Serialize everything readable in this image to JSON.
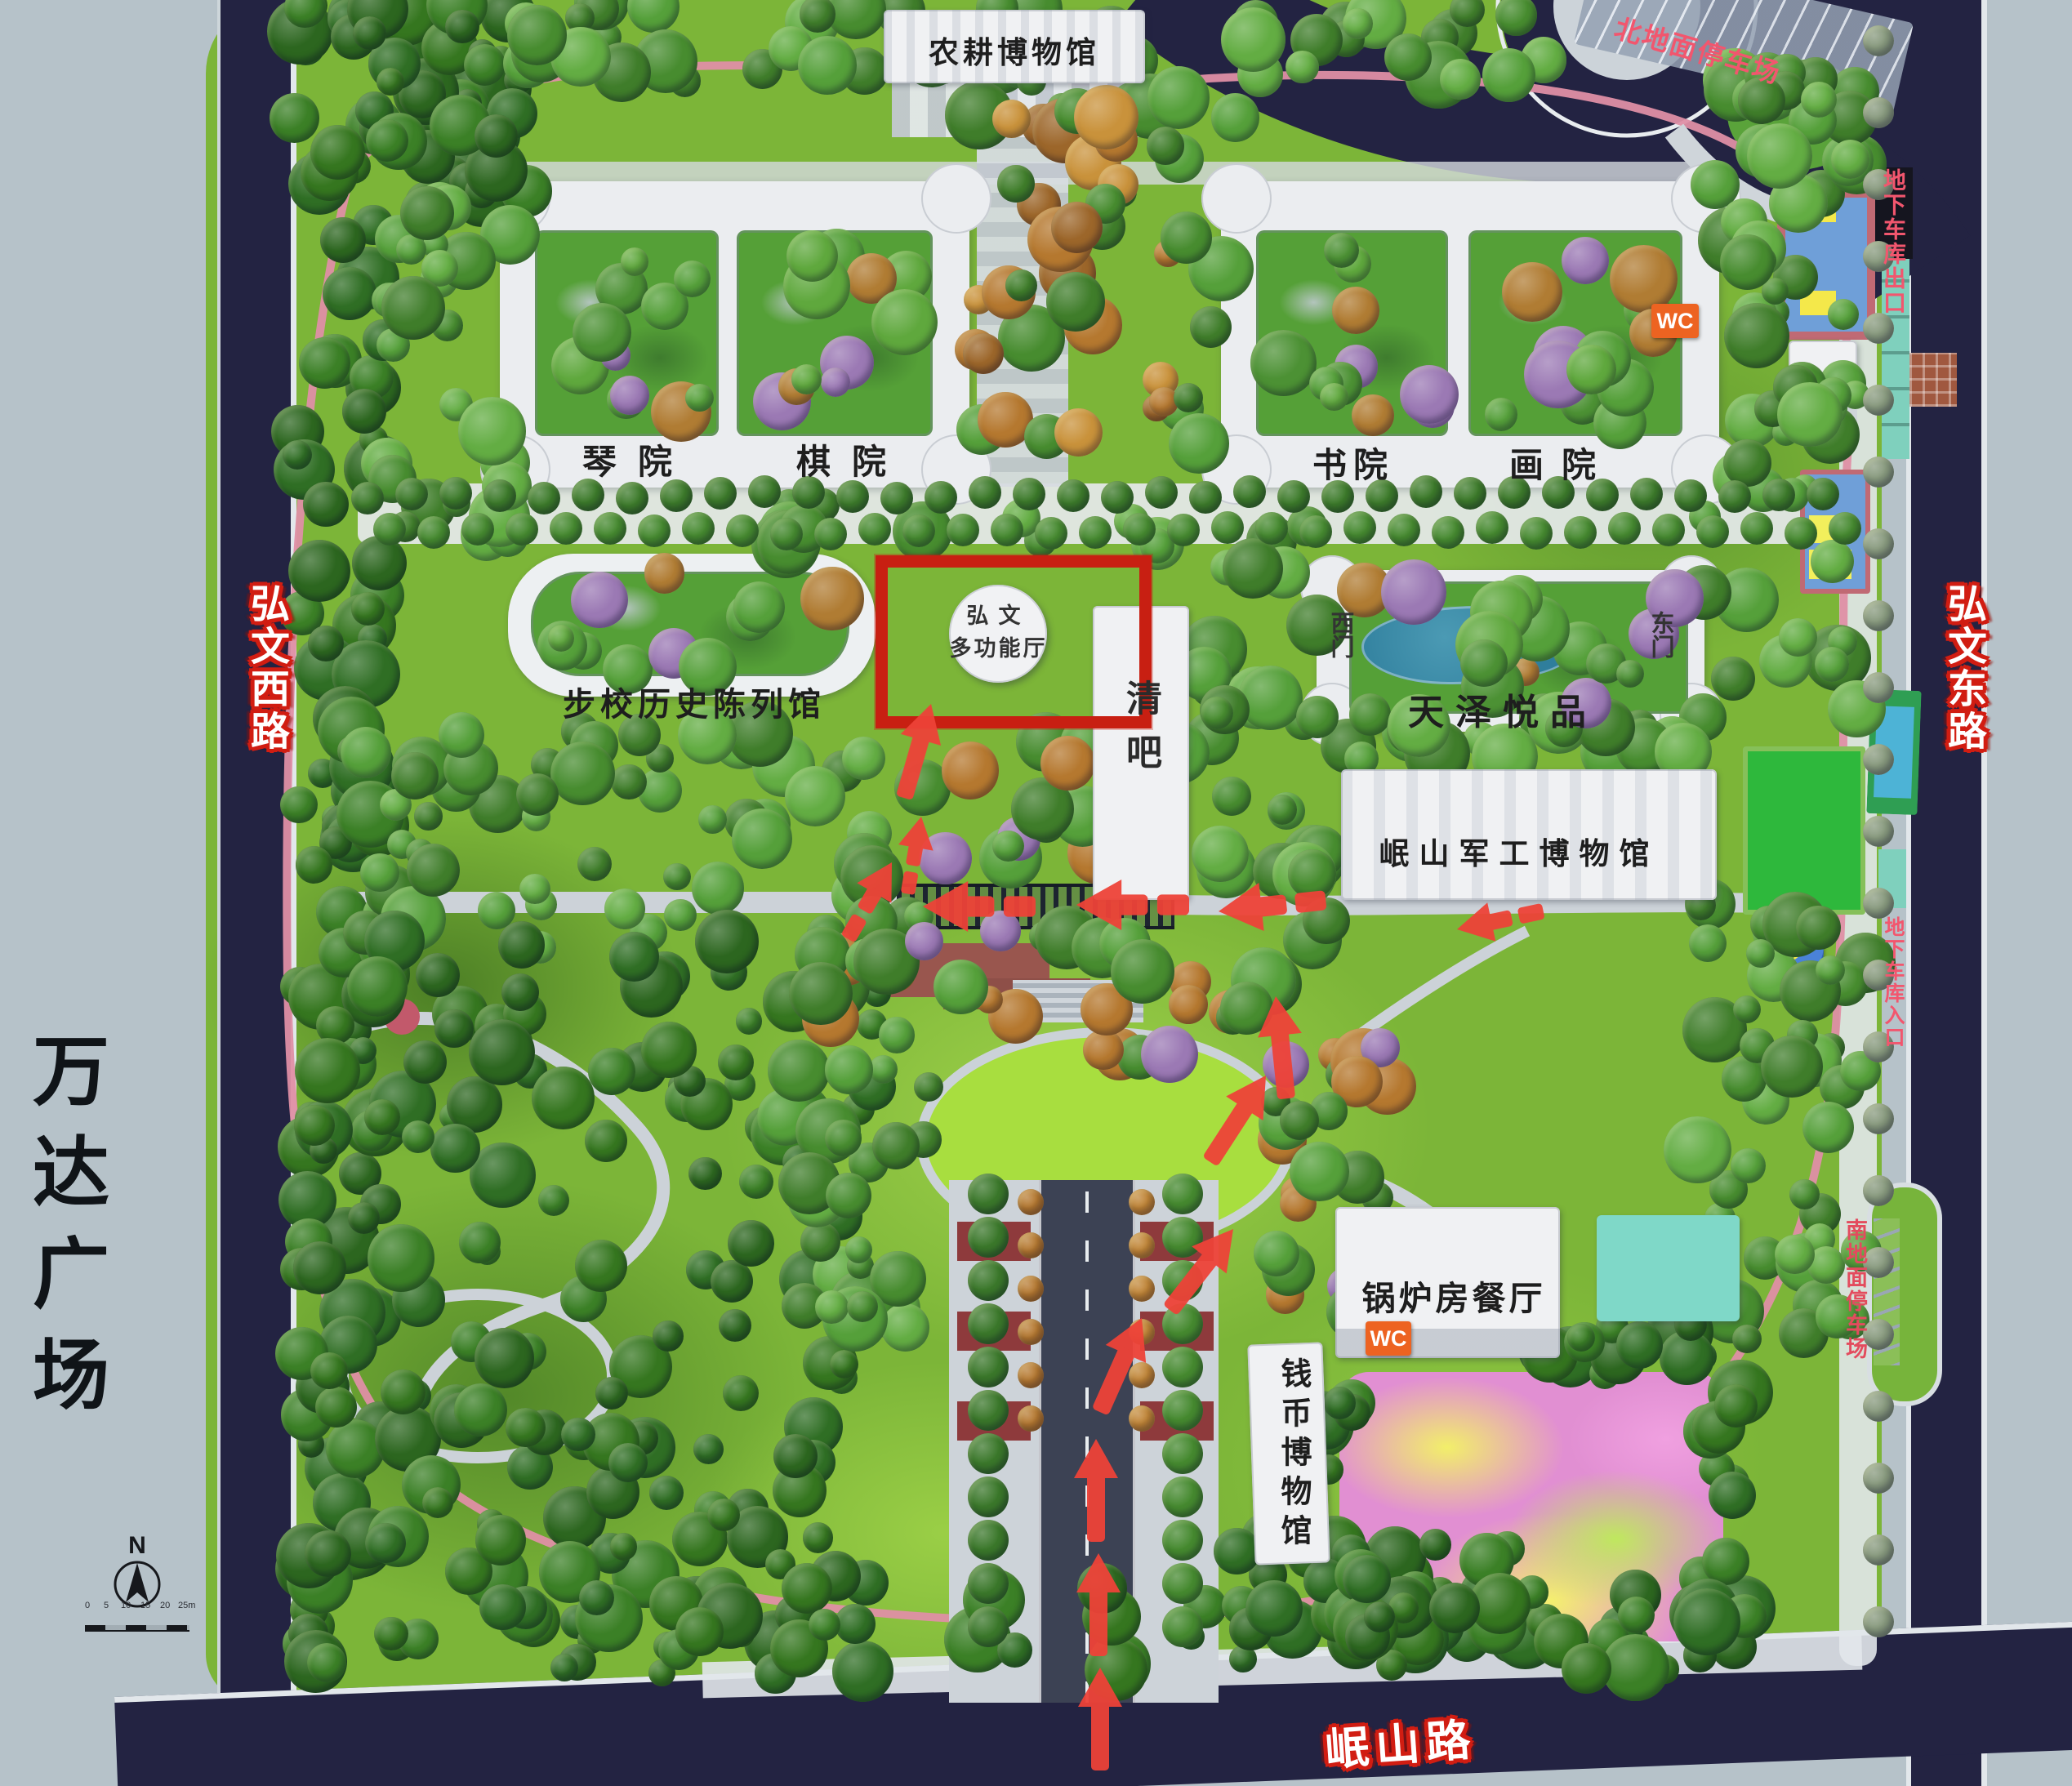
{
  "roads": {
    "west": "弘文西路",
    "east": "弘文东路",
    "south": "岷山路"
  },
  "surroundings": {
    "wanda_plaza": "万达广场"
  },
  "parking": {
    "north_lot": "北地面停车场",
    "south_lot": "南地面停车场",
    "garage_exit": "地下车库出口",
    "garage_entrance": "地下车库入口"
  },
  "venues": {
    "farming_museum": "农耕博物馆",
    "qin_court": "琴院",
    "chess_court": "棋院",
    "book_court": "书院",
    "painting_court": "画院",
    "infantry_school_hall": "步校历史陈列馆",
    "bar": "清吧",
    "tianze_yuepin": "天泽悦品",
    "military_museum": "岷山军工博物馆",
    "boiler_restaurant": "锅炉房餐厅",
    "coin_museum": "钱币博物馆"
  },
  "highlight": {
    "name_line1": "弘文",
    "name_line2": "多功能厅"
  },
  "gates": {
    "west": "西门",
    "east": "东门"
  },
  "badges": {
    "wc": "WC"
  },
  "compass": {
    "north": "N"
  },
  "scalebar": {
    "ticks": [
      "0",
      "5",
      "10",
      "15",
      "20",
      "25m"
    ]
  },
  "colors": {
    "road_navy": "#232342",
    "park_green": "#7cb538",
    "highlight_red": "#c81f12",
    "arrow_red": "#ee4338",
    "parking_label_pink": "#f2566e",
    "road_label_outline": "#d11d12",
    "wc_orange": "#ed6321",
    "water_teal": "#2f7e9c",
    "jogging_loop_pink": "#df8fa5"
  }
}
